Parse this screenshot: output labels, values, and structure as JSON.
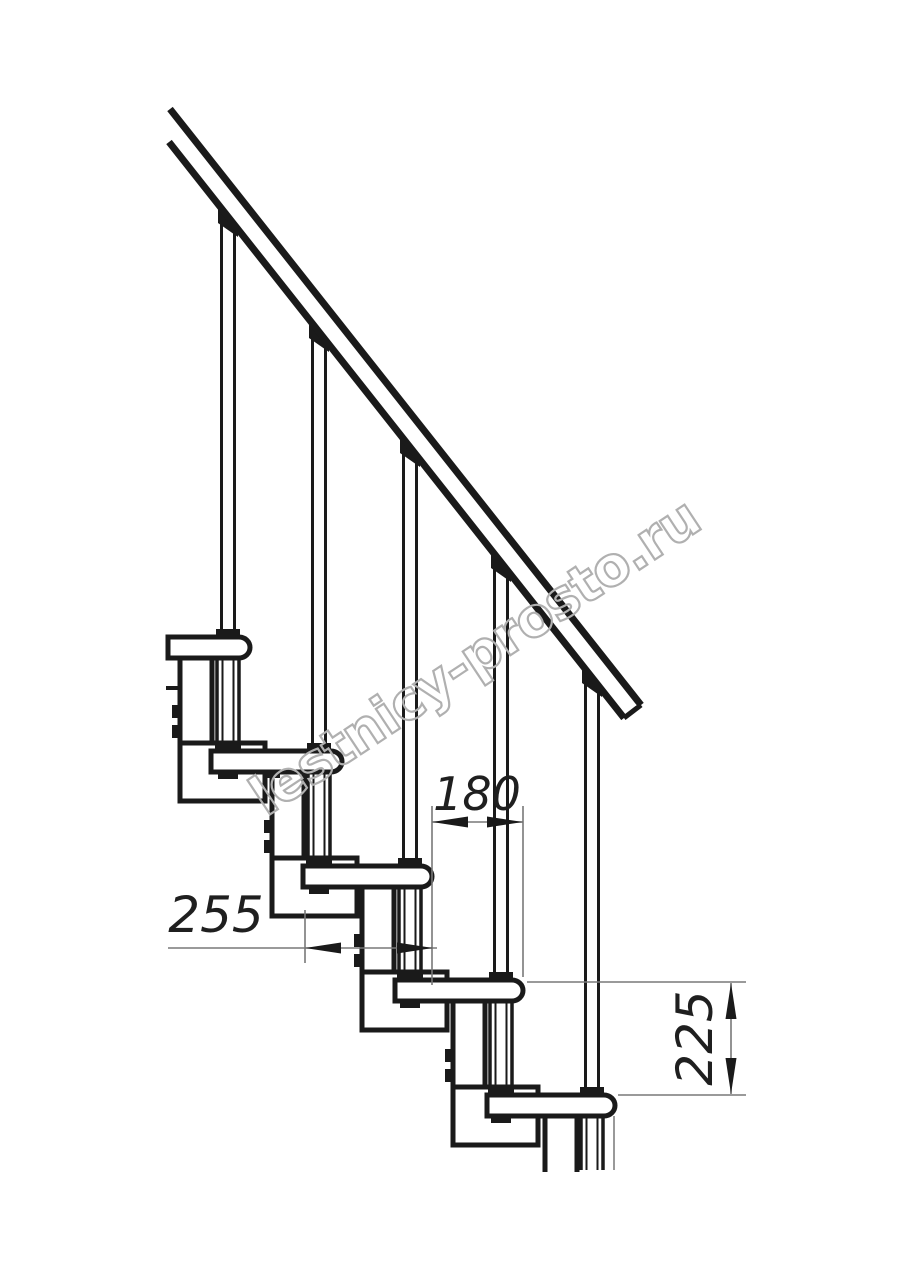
{
  "watermark": {
    "text": "lestnicy-prosto.ru",
    "color": "#b0b0b0"
  },
  "dimensions": {
    "step_run": {
      "value": "180",
      "orientation": "horizontal"
    },
    "tread_depth": {
      "value": "255",
      "orientation": "horizontal"
    },
    "step_rise": {
      "value": "225",
      "orientation": "vertical"
    }
  },
  "colors": {
    "background": "#ffffff",
    "drawing_line": "#1a1a1a",
    "dimension_line": "#787878",
    "dimension_text": "#1f1f1f",
    "watermark": "#b0b0b0"
  }
}
